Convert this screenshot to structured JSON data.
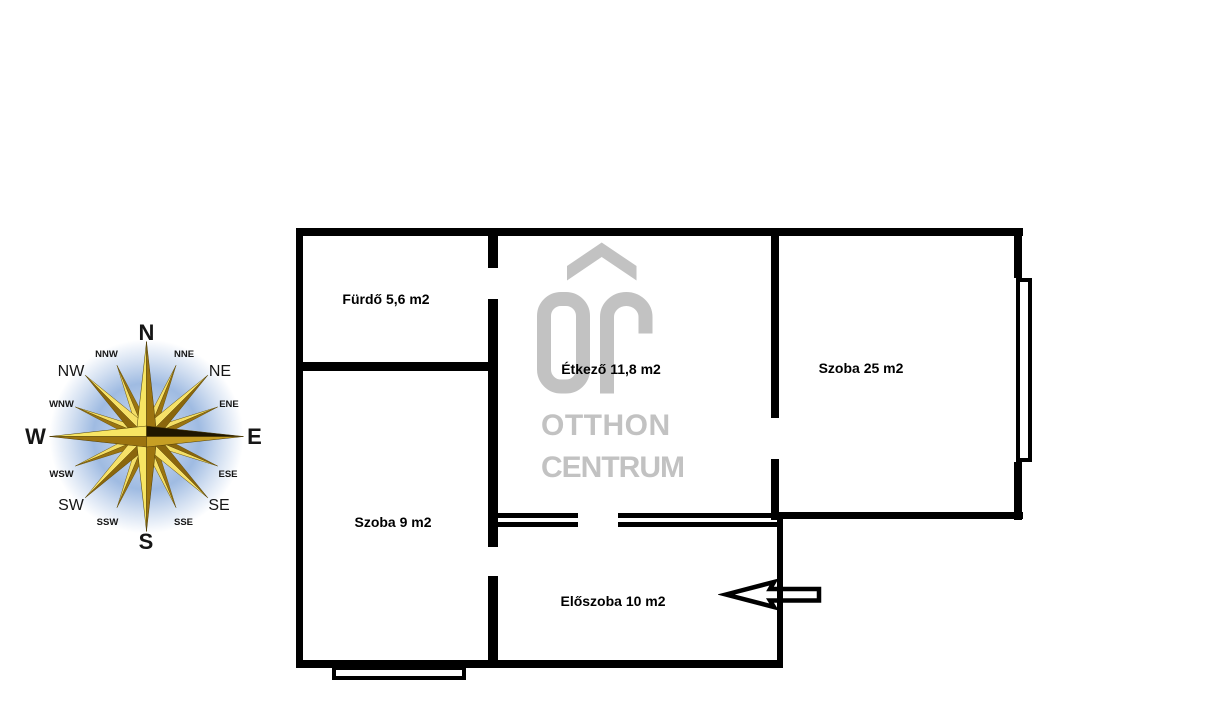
{
  "floor_plan": {
    "wall_color": "#000000",
    "rooms": [
      {
        "id": "furdo",
        "label": "Fürdő 5,6 m2"
      },
      {
        "id": "etkezo",
        "label": "Étkező 11,8 m2"
      },
      {
        "id": "szoba25",
        "label": "Szoba 25 m2"
      },
      {
        "id": "szoba9",
        "label": "Szoba 9 m2"
      },
      {
        "id": "eloszoba",
        "label": "Előszoba 10 m2"
      }
    ],
    "entrance_arrow_direction": "left"
  },
  "watermark": {
    "monogram": "OC",
    "brand_line1": "OTTHON",
    "brand_line2": "CENTRUM",
    "color": "#c2c2c2"
  },
  "compass": {
    "labels": {
      "n": "N",
      "nne": "NNE",
      "ne": "NE",
      "ene": "ENE",
      "e": "E",
      "ese": "ESE",
      "se": "SE",
      "sse": "SSE",
      "s": "S",
      "ssw": "SSW",
      "sw": "SW",
      "wsw": "WSW",
      "w": "W",
      "wnw": "WNW",
      "nw": "NW",
      "nnw": "NNW"
    },
    "colors": {
      "gold_light": "#f6e168",
      "gold_dark": "#9c7410",
      "glow": "#a9c2e4"
    }
  }
}
